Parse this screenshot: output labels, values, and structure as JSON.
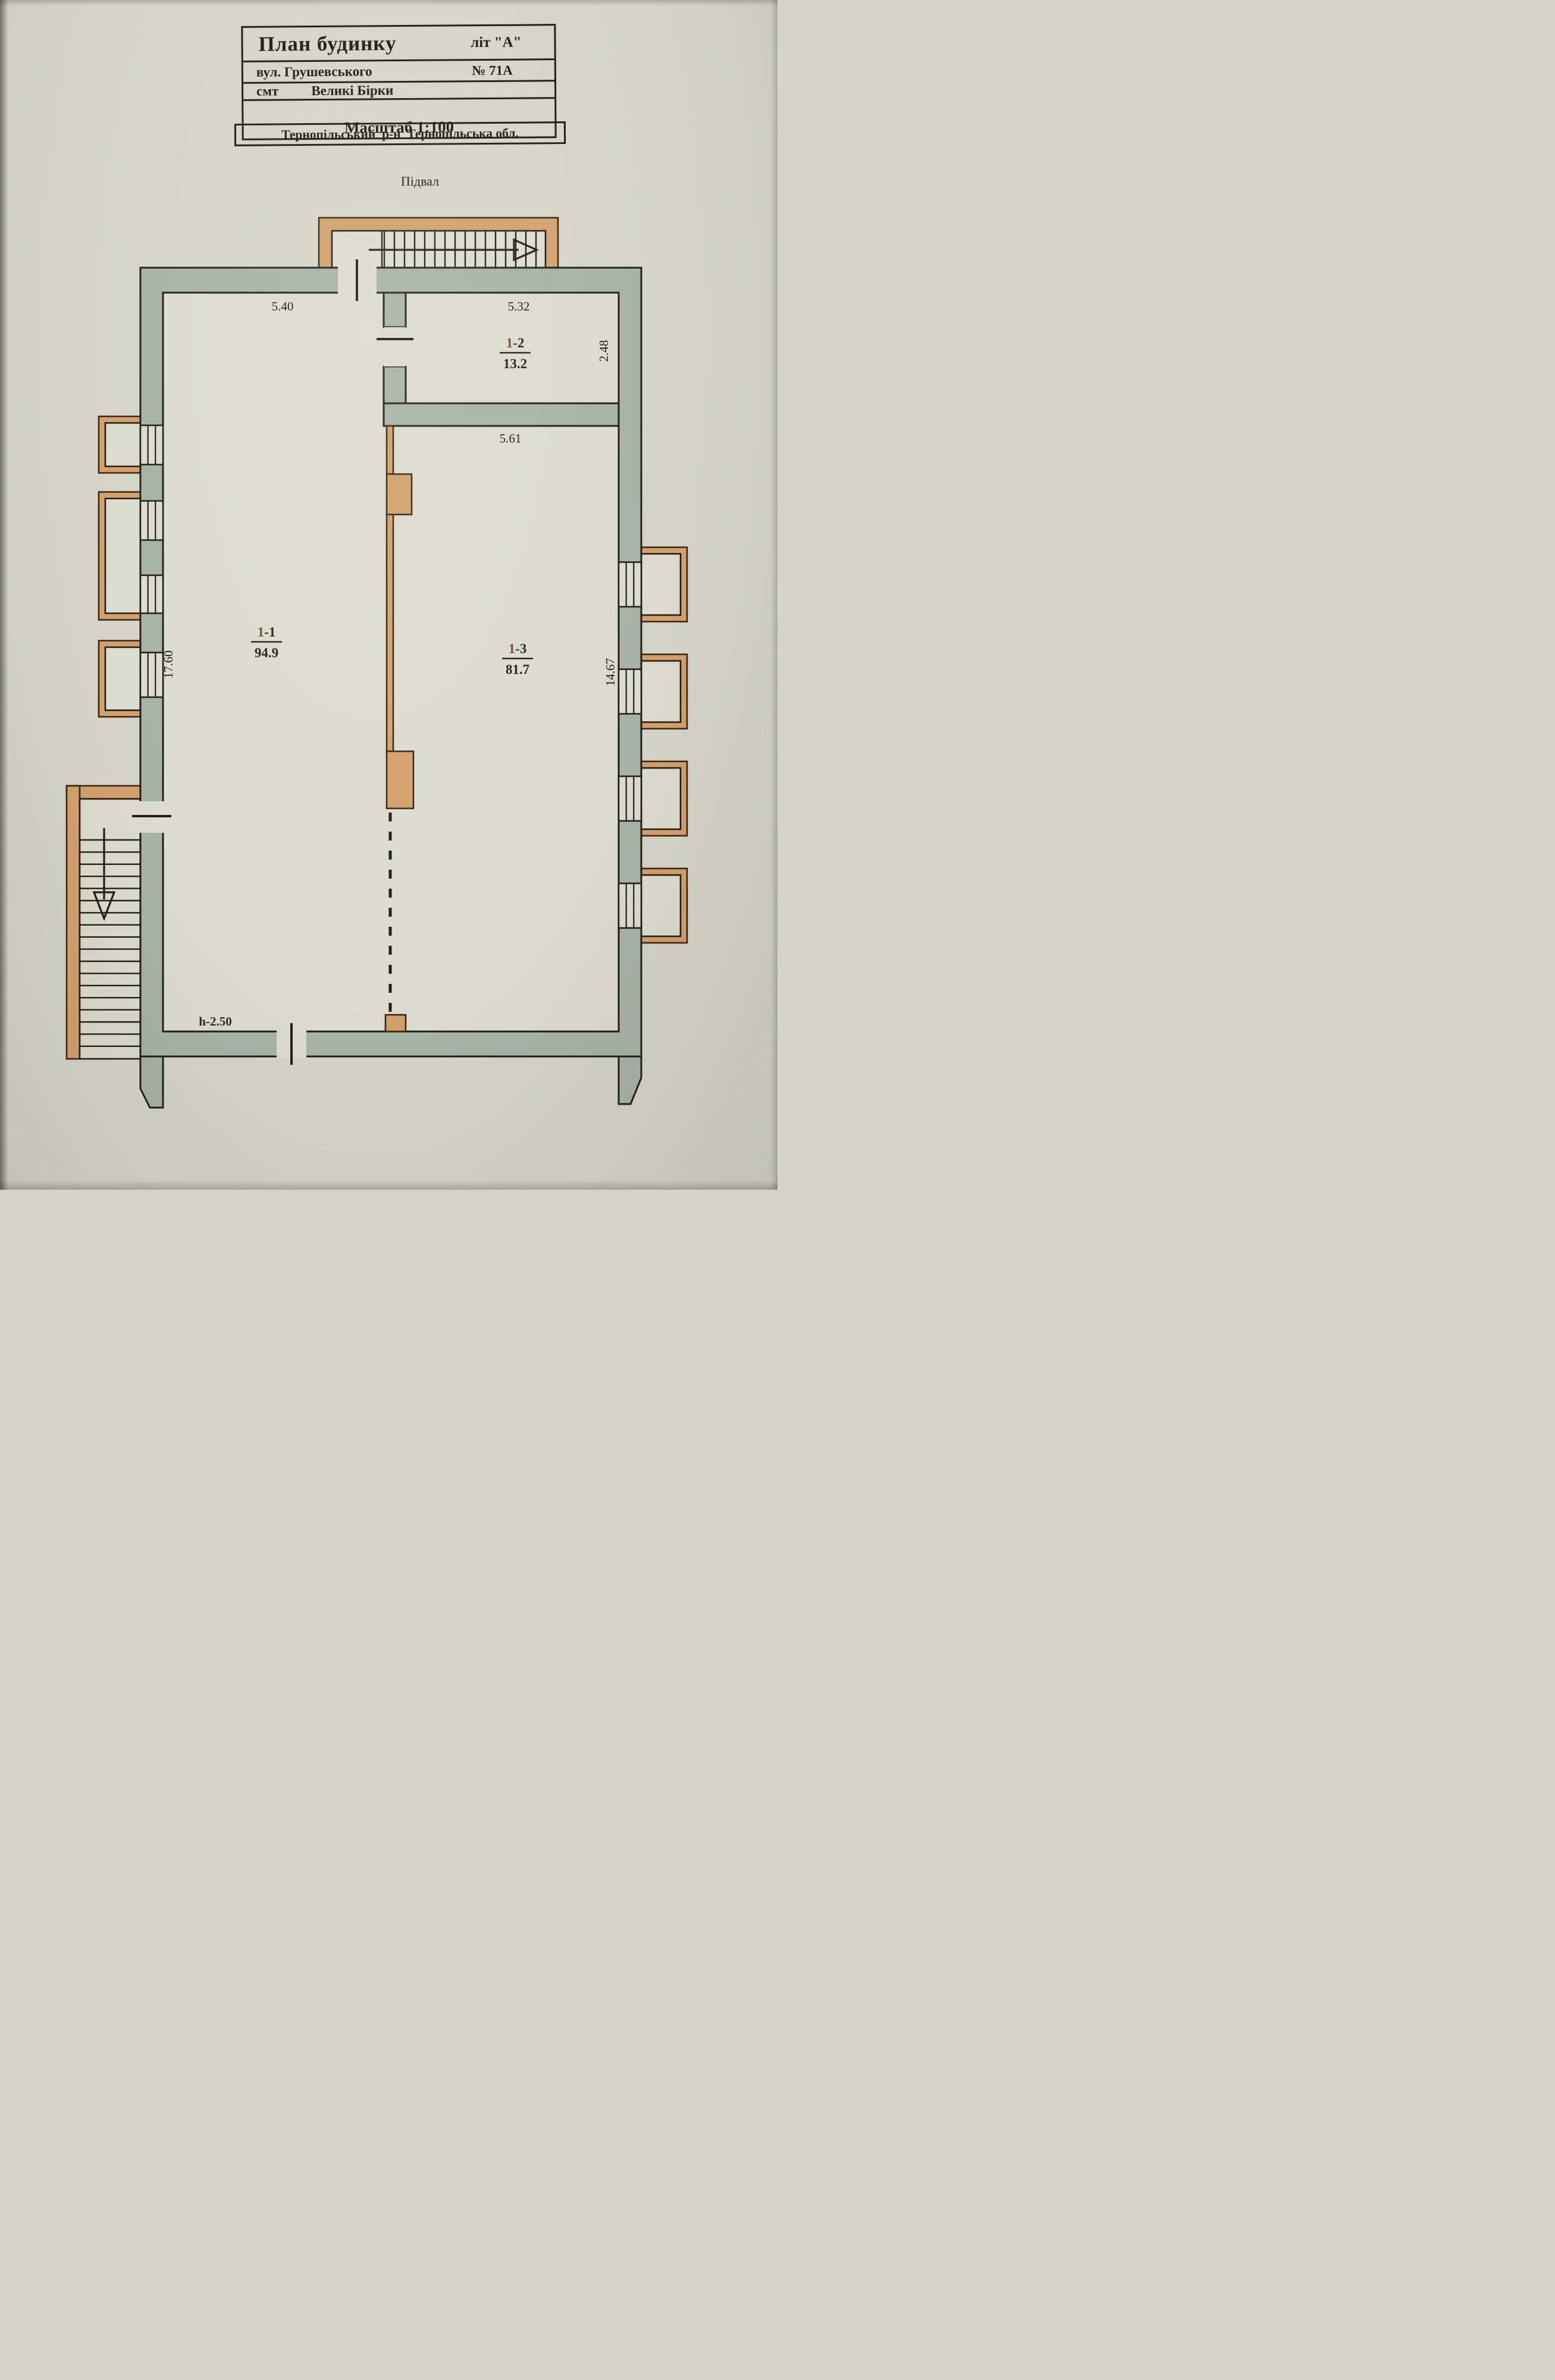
{
  "document": {
    "title_block": {
      "line1_left": "План будинку",
      "line1_right": "літ \"А\"",
      "line2_left": "вул. Грушевського",
      "line2_right": "№ 71А",
      "line3_left": "смт",
      "line3_right": "Великі Бірки",
      "line4": "Тернопільський  р-н  Тернопільська обл.",
      "line5": "Масштаб 1:100"
    },
    "floor_label": "Підвал",
    "rooms": [
      {
        "prefix": "1",
        "suffix": "-1",
        "area": "94.9"
      },
      {
        "prefix": "1",
        "suffix": "-2",
        "area": "13.2"
      },
      {
        "prefix": "1",
        "suffix": "-3",
        "area": "81.7"
      }
    ],
    "dimensions": {
      "room1_top_width": "5.40",
      "room2_top_width": "5.32",
      "room2_right_height": "2.48",
      "room2_bottom_width": "5.61",
      "left_height": "17.60",
      "right_height": "14.67",
      "height_note": "h-2.50"
    },
    "colors": {
      "paper": "#d5d4ca",
      "paper-room": "#dcdbd1",
      "wall": "#a7b2a8",
      "masonry": "#d2a06c",
      "line": "#241d14",
      "ink": "#1d1812",
      "accent": "#7c463e"
    }
  }
}
